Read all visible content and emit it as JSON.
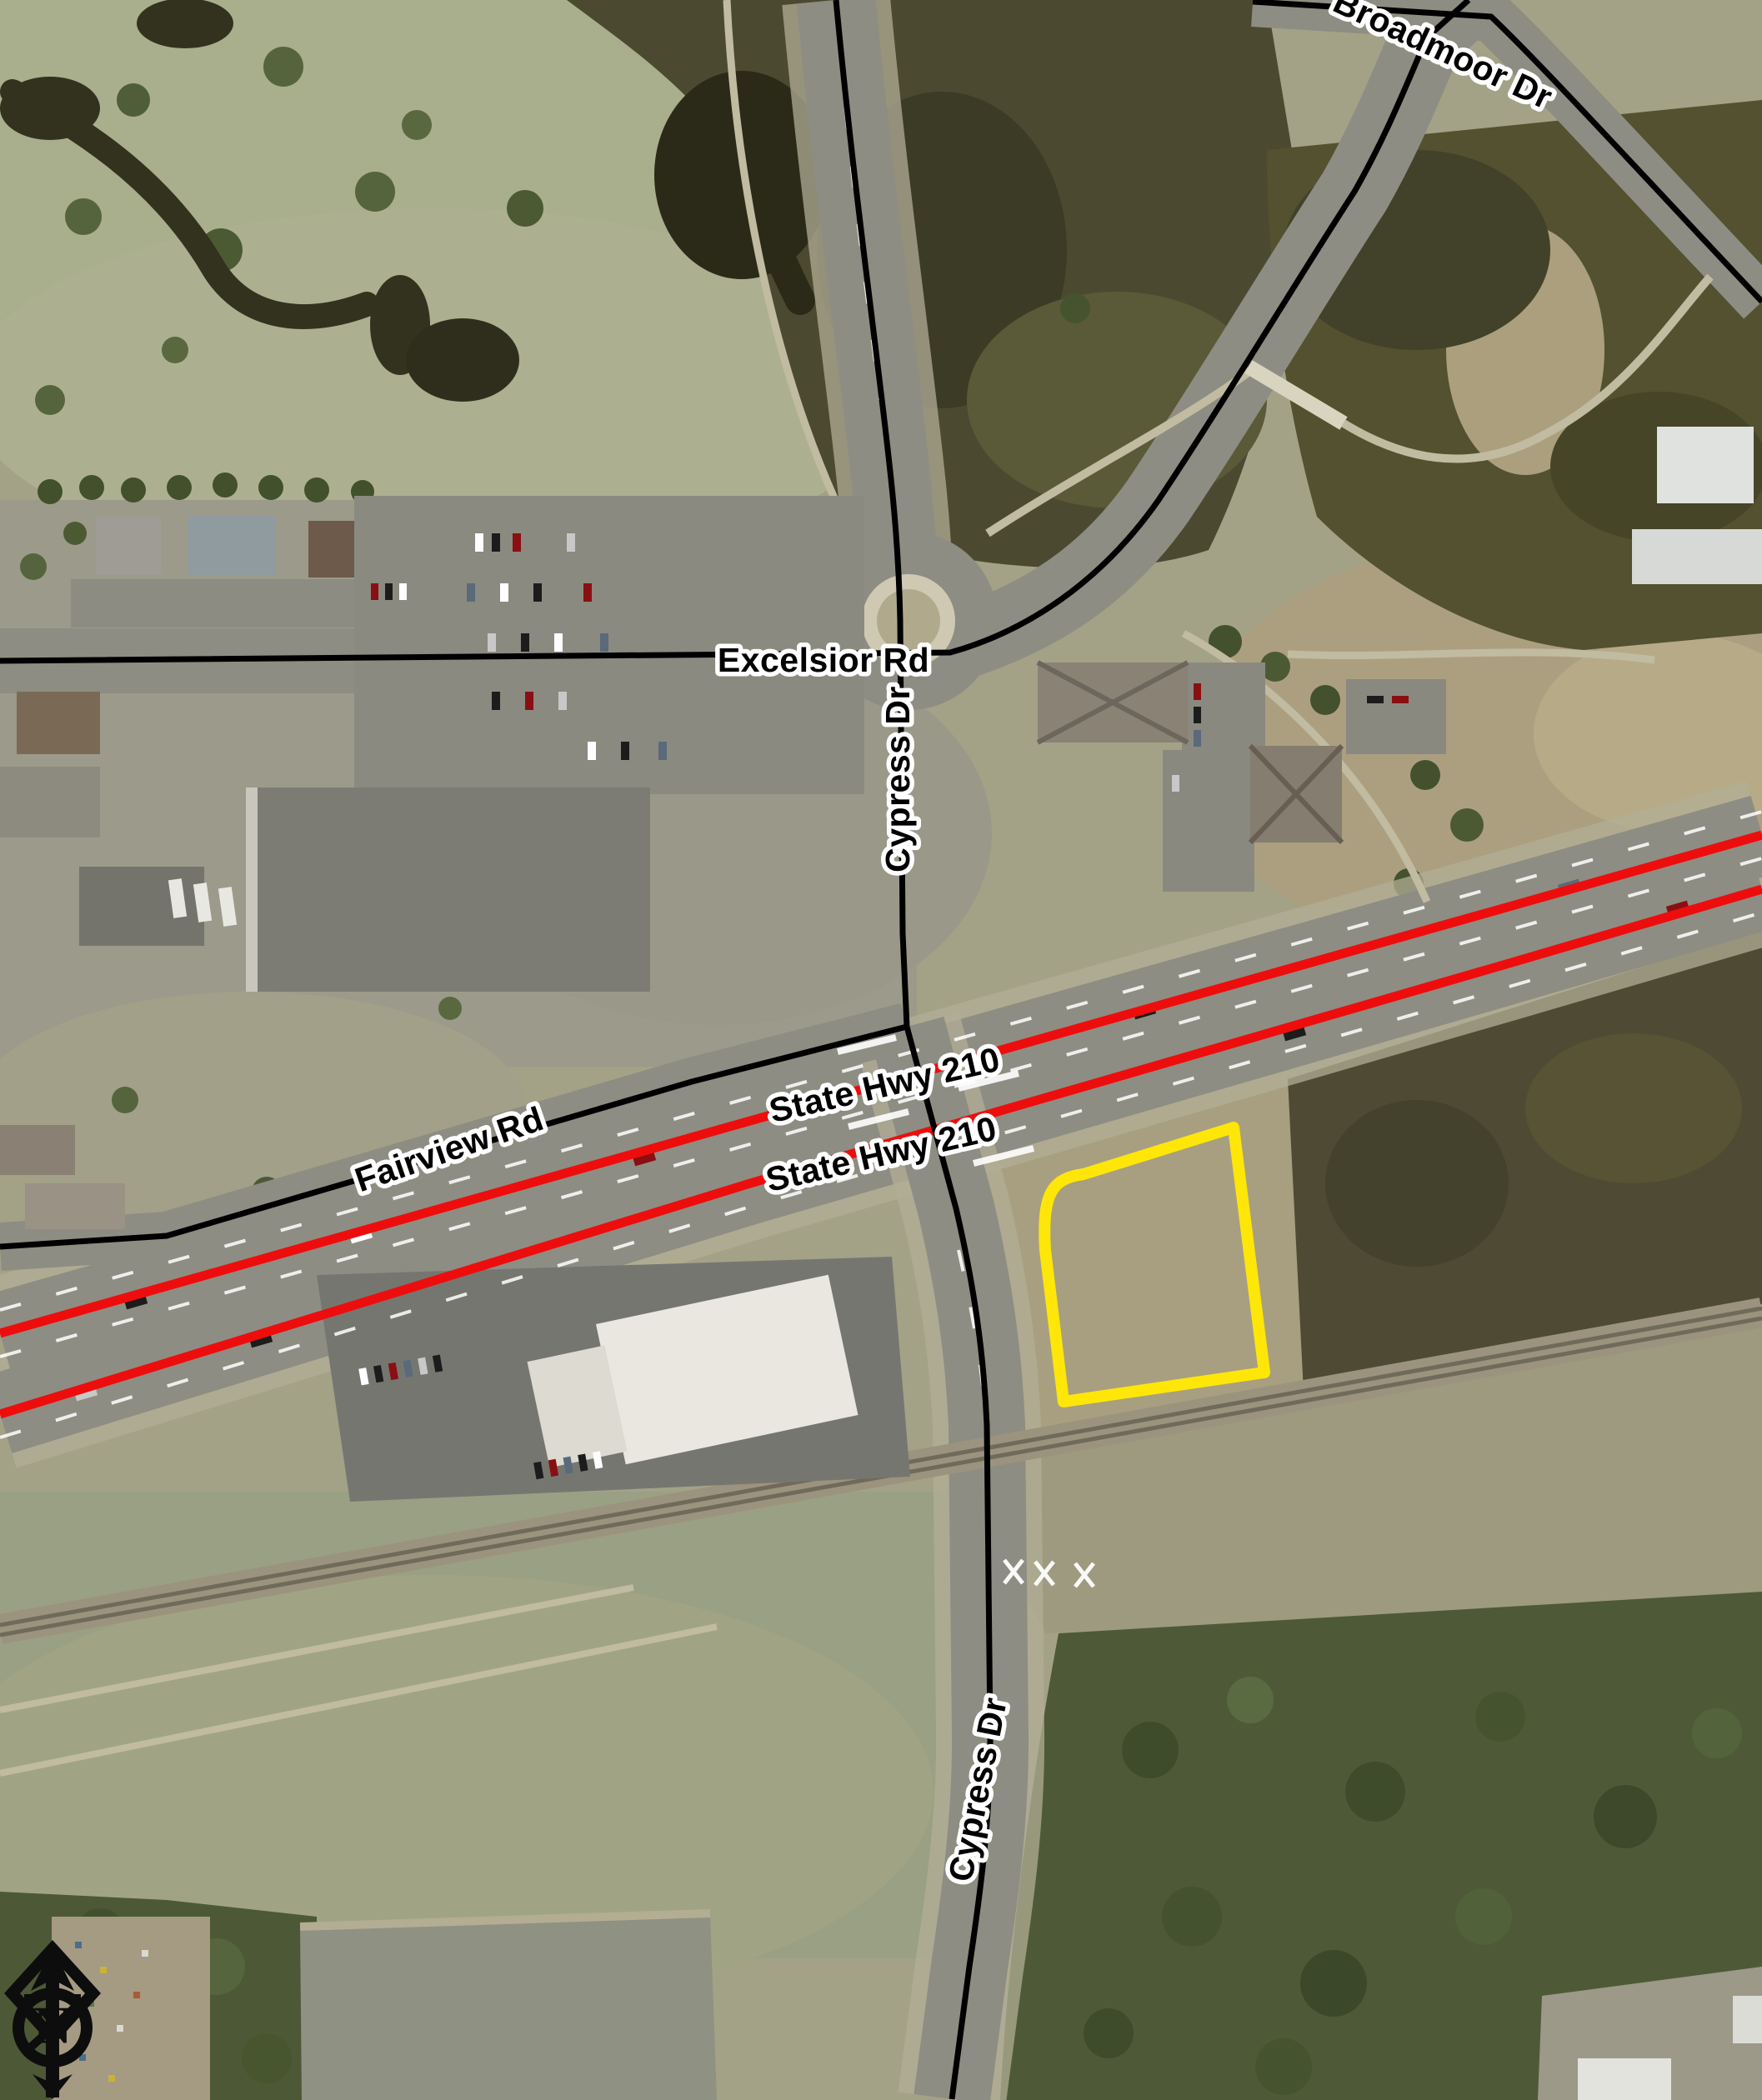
{
  "map": {
    "labels": {
      "broadmoor": "Broadmoor Dr",
      "excelsior": "Excelsior Rd",
      "cypress_north": "Cypress Dr",
      "fairview": "Fairview Rd",
      "hwy210_upper": "State Hwy 210",
      "hwy210_lower": "State Hwy 210",
      "cypress_south": "Cypress Dr"
    },
    "north_arrow": {
      "letter": "N"
    },
    "colors": {
      "highway_highlight": "#ee0d0d",
      "road_centerline": "#000000",
      "parcel_outline": "#ffe609",
      "label_text": "#000000",
      "label_outline": "#ffffff"
    }
  }
}
